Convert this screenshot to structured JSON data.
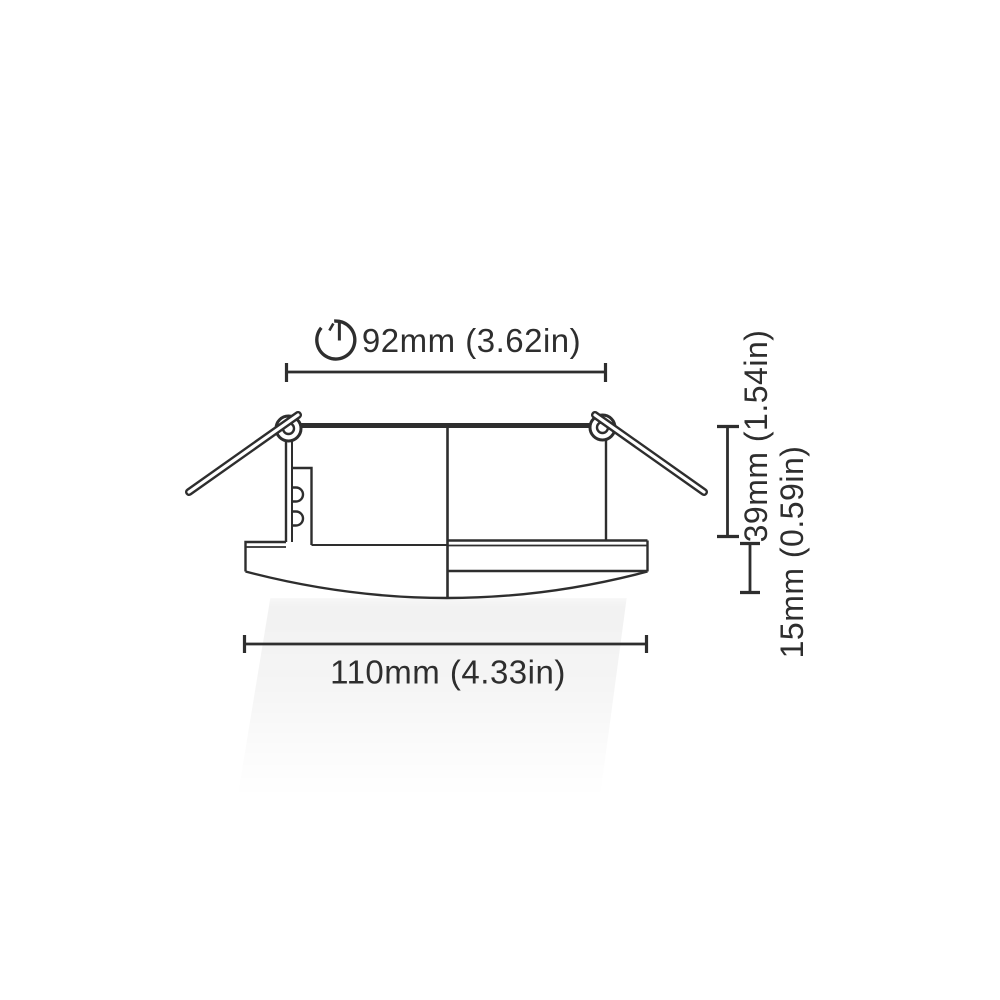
{
  "labels": {
    "cutout_diameter": "92mm (3.62in)",
    "recess_depth": "39mm (1.54in)",
    "bezel_height": "15mm (0.59in)",
    "overall_width": "110mm (4.33in)"
  },
  "icons": {
    "cutout": "cutout-diameter-icon"
  },
  "colors": {
    "line": "#2e2e2e",
    "background": "#ffffff",
    "beam_shading": "#f2f2f2"
  }
}
